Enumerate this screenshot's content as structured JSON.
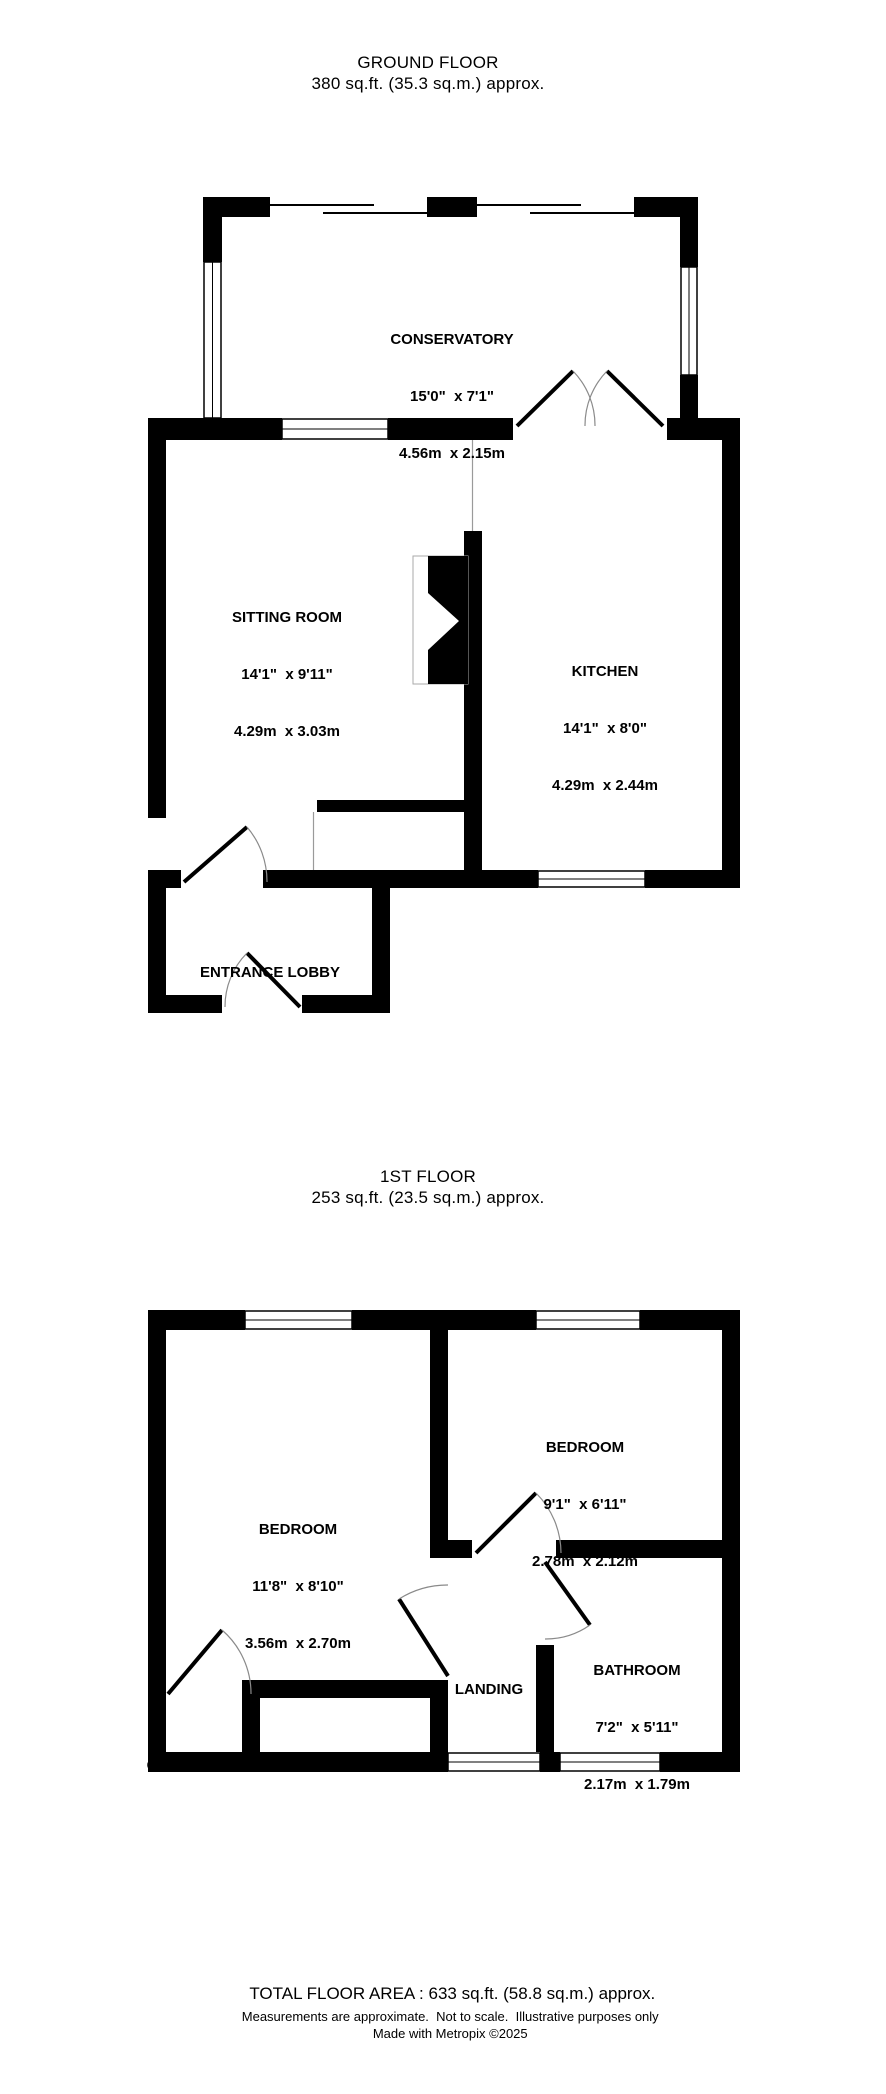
{
  "ground_floor": {
    "title": "GROUND FLOOR",
    "subtitle": "380 sq.ft. (35.3 sq.m.) approx.",
    "rooms": {
      "conservatory": {
        "name": "CONSERVATORY",
        "imperial": "15'0\"  x 7'1\"",
        "metric": "4.56m  x 2.15m"
      },
      "sitting_room": {
        "name": "SITTING ROOM",
        "imperial": "14'1\"  x 9'11\"",
        "metric": "4.29m  x 3.03m"
      },
      "kitchen": {
        "name": "KITCHEN",
        "imperial": "14'1\"  x 8'0\"",
        "metric": "4.29m  x 2.44m"
      },
      "stairs": {
        "name": "STAIRS"
      },
      "entrance_lobby": {
        "name": "ENTRANCE LOBBY"
      }
    }
  },
  "first_floor": {
    "title": "1ST FLOOR",
    "subtitle": "253 sq.ft. (23.5 sq.m.) approx.",
    "rooms": {
      "bedroom_left": {
        "name": "BEDROOM",
        "imperial": "11'8\"  x 8'10\"",
        "metric": "3.56m  x 2.70m"
      },
      "bedroom_right": {
        "name": "BEDROOM",
        "imperial": "9'1\"  x 6'11\"",
        "metric": "2.78m  x 2.12m"
      },
      "bathroom": {
        "name": "BATHROOM",
        "imperial": "7'2\"  x 5'11\"",
        "metric": "2.17m  x 1.79m"
      },
      "landing": {
        "name": "LANDING"
      },
      "stairs": {
        "name": "STAIRS"
      },
      "cupboard": {
        "name": "CUPBOARD"
      }
    }
  },
  "footer": {
    "total": "TOTAL FLOOR AREA : 633 sq.ft. (58.8 sq.m.) approx.",
    "disclaimer": "Measurements are approximate.  Not to scale.  Illustrative purposes only",
    "credit": "Made with Metropix ©2025"
  },
  "colors": {
    "wall": "#000000",
    "door_arc": "#8a8a8a"
  }
}
